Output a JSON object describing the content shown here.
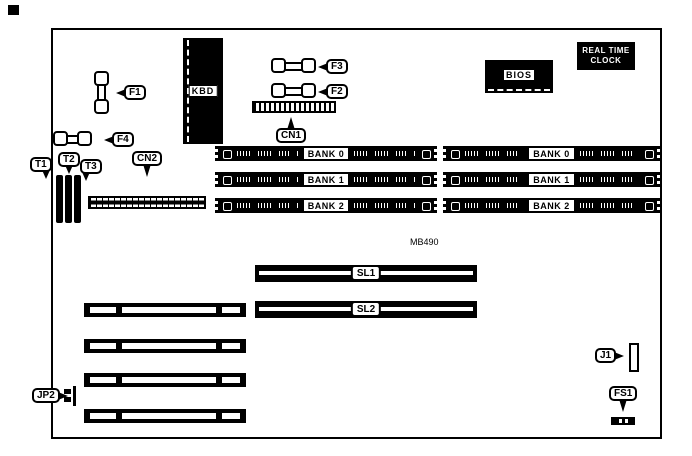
{
  "diagram": {
    "model": "MB490",
    "colors": {
      "ink": "#000000",
      "paper": "#ffffff"
    },
    "labels": {
      "kbd": "KBD",
      "bios": "BIOS",
      "rtc_line1": "REAL TIME",
      "rtc_line2": "CLOCK",
      "f1": "F1",
      "f2": "F2",
      "f3": "F3",
      "f4": "F4",
      "cn1": "CN1",
      "cn2": "CN2",
      "t1": "T1",
      "t2": "T2",
      "t3": "T3",
      "sl1": "SL1",
      "sl2": "SL2",
      "jp2": "JP2",
      "j1": "J1",
      "fs1": "FS1"
    },
    "memory": {
      "left_banks": [
        "BANK 0",
        "BANK 1",
        "BANK 2"
      ],
      "right_banks": [
        "BANK 0",
        "BANK 1",
        "BANK 2"
      ]
    }
  }
}
